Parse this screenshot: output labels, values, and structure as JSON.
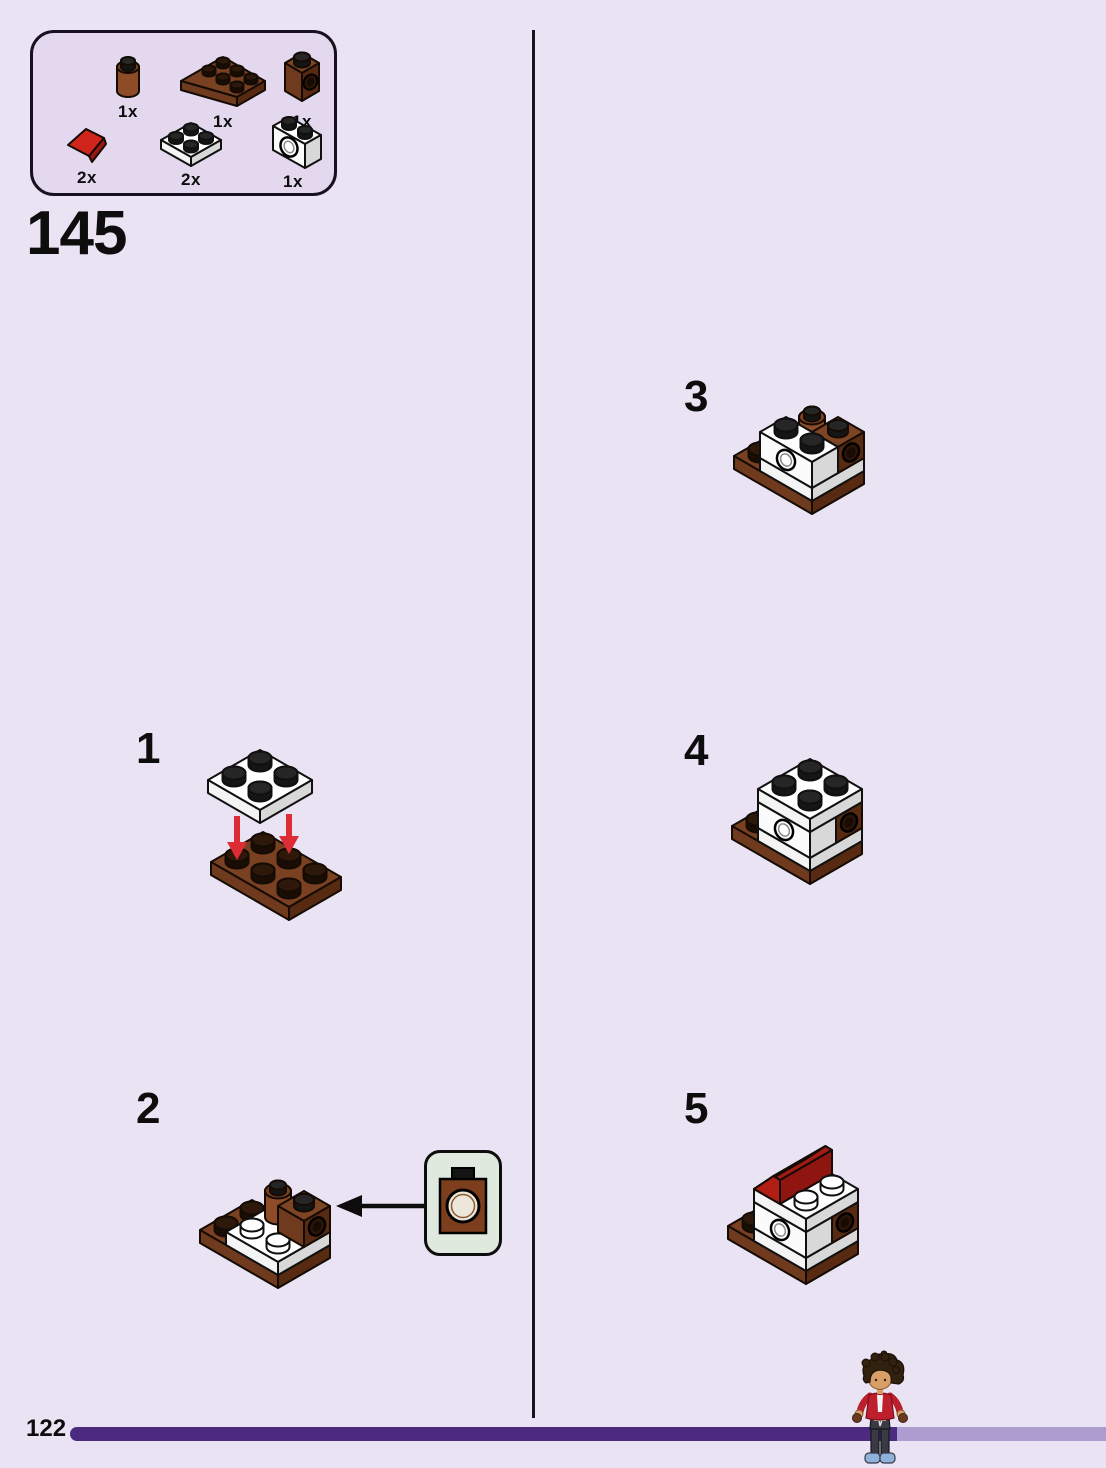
{
  "page": {
    "number": "122"
  },
  "heading": {
    "step_number": "145"
  },
  "parts_panel": {
    "items": [
      {
        "part": "brick-round-1x1-reddish-brown",
        "count": "1x"
      },
      {
        "part": "plate-2x3-reddish-brown",
        "count": "1x"
      },
      {
        "part": "technic-brick-1x1-hole-reddish-brown",
        "count": "1x"
      },
      {
        "part": "slope-1x1-red",
        "count": "2x"
      },
      {
        "part": "plate-2x2-white",
        "count": "2x"
      },
      {
        "part": "technic-brick-1x2-hole-white",
        "count": "1x"
      }
    ]
  },
  "steps": [
    {
      "number": "1"
    },
    {
      "number": "2"
    },
    {
      "number": "3"
    },
    {
      "number": "4"
    },
    {
      "number": "5"
    }
  ],
  "callout": {
    "description": "technic-brick-1x1-hole-actual-size"
  },
  "colors": {
    "page_background": "#EAE3F3",
    "parts_panel_background": "#E3D8EE",
    "callout_background": "#E0E9DD",
    "outline_black": "#0D0D0D",
    "progress_bar_dark": "#4B2A80",
    "progress_bar_light": "#AC9CD0",
    "brick_brown": "#7A4022",
    "brick_white": "#FFFFFF",
    "brick_red": "#D0251C",
    "arrow_red": "#DD2C35"
  }
}
